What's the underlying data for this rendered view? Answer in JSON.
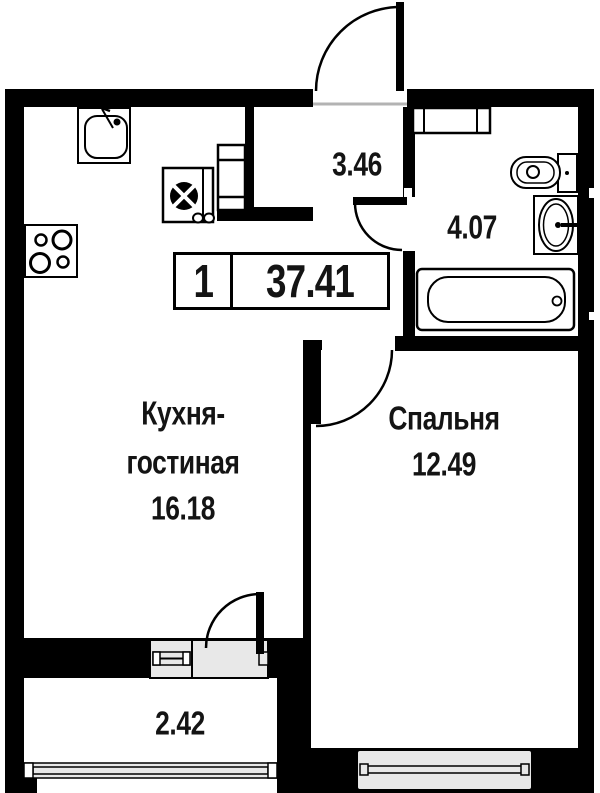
{
  "plan": {
    "title": "apartment-floor-plan",
    "badge": {
      "rooms_count": "1",
      "total_area": "37.41"
    },
    "rooms": {
      "hallway": {
        "area": "3.46"
      },
      "bathroom": {
        "area": "4.07"
      },
      "kitchen_living": {
        "name_line1": "Кухня-",
        "name_line2": "гостиная",
        "area": "16.18"
      },
      "bedroom": {
        "name": "Спальня",
        "area": "12.49"
      },
      "balcony": {
        "area": "2.42"
      }
    },
    "fixtures": [
      "kitchen-sink",
      "refrigerator",
      "stove",
      "wardrobe",
      "vent-shaft",
      "toilet",
      "washbasin",
      "bathtub"
    ],
    "colors": {
      "wall": "#000000",
      "background": "#ffffff",
      "window_fill": "#e8e8e8",
      "threshold": "#b3b3b3"
    }
  }
}
